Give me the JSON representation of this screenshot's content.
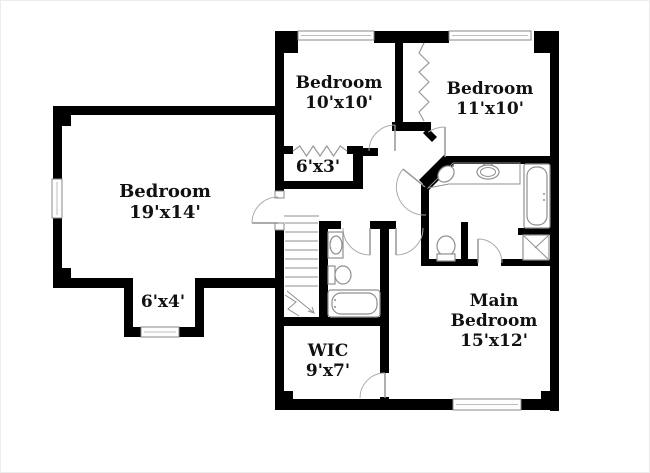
{
  "floor_plan": {
    "rooms": [
      {
        "id": "bedroom-10x10",
        "lines": [
          "Bedroom",
          "10'x10'"
        ]
      },
      {
        "id": "bedroom-11x10",
        "lines": [
          "Bedroom",
          "11'x10'"
        ]
      },
      {
        "id": "bedroom-19x14",
        "lines": [
          "Bedroom",
          "19'x14'"
        ]
      },
      {
        "id": "closet-6x3",
        "lines": [
          "6'x3'"
        ]
      },
      {
        "id": "nook-6x4",
        "lines": [
          "6'x4'"
        ]
      },
      {
        "id": "wic-9x7",
        "lines": [
          "WIC",
          "9'x7'"
        ]
      },
      {
        "id": "main-bedroom-15x12",
        "lines": [
          "Main",
          "Bedroom",
          "15'x12'"
        ]
      }
    ],
    "fixtures": [
      "staircase",
      "bathtub",
      "shower",
      "toilet",
      "double-vanity",
      "vanity-sink",
      "window",
      "door-swing",
      "accordion-closet-door"
    ],
    "colors": {
      "wall": "#000000",
      "fixture_line": "#8f8f8f",
      "door_arc": "#ababab",
      "text": "#111111",
      "background": "#ffffff",
      "window_fill": "#fdfdfd"
    }
  }
}
